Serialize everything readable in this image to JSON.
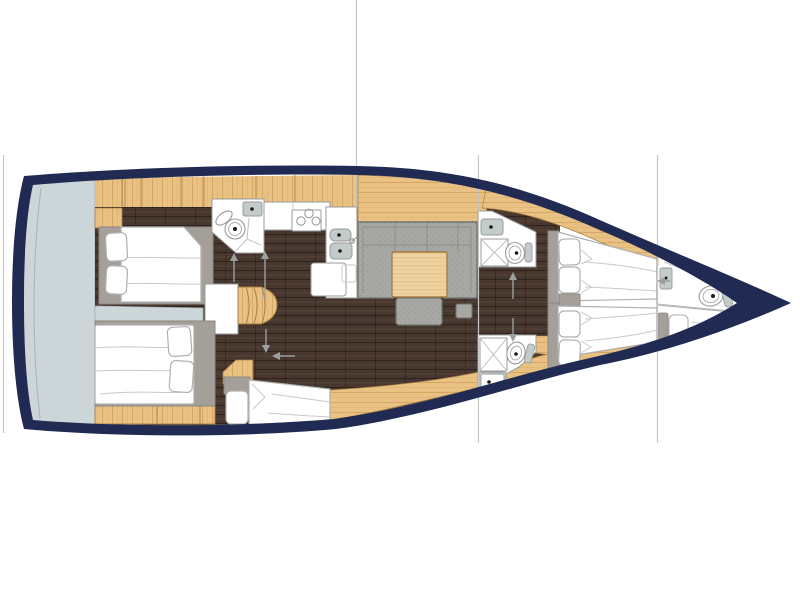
{
  "meta": {
    "type": "sailing-yacht-interior-floor-plan",
    "orientation": "bow-right",
    "canvas": {
      "width": 800,
      "height": 600
    }
  },
  "palette": {
    "background": "#ffffff",
    "hull_navy": "#212a52",
    "deck_gray": "#ccd5d8",
    "deck_gray_line": "#a9b3b7",
    "wood": "#e9c183",
    "wood_grain": "#cfa15c",
    "wood_edge": "#a97f44",
    "wood_light": "#eed2a0",
    "wood_light_grain": "#d9b476",
    "floor_dark": "#47372e",
    "floor_streak_dark": "#2f231d",
    "floor_streak_light": "#5a473c",
    "sofa_gray": "#a7a7a4",
    "sofa_dot": "#929290",
    "sofa_edge": "#73736f",
    "trim_gray": "#a49f98",
    "trim_edge": "#8d8781",
    "fixture_white": "#ffffff",
    "fixture_edge": "#9b9b9b",
    "sink_gray": "#c3cbcb",
    "glass_line": "#b9b9b9",
    "bed_edge": "#b0b0b0",
    "fold_line": "#c9c9c9",
    "section_line": "#c6c6c6",
    "arrow_gray": "#9aa0a0",
    "dot_black": "#1a1a1a"
  },
  "section_lines": {
    "xs": [
      3.5,
      356.5,
      478.5,
      657.5
    ]
  },
  "rooms": [
    {
      "id": "stern-platform",
      "fixtures": []
    },
    {
      "id": "aft-cabin-port",
      "fixtures": [
        "double-bed",
        "pillows",
        "wardrobe-cabinets"
      ]
    },
    {
      "id": "aft-cabin-starboard",
      "fixtures": [
        "double-bed",
        "pillows",
        "drawer-cabinets"
      ]
    },
    {
      "id": "aft-head",
      "fixtures": [
        "toilet",
        "sink",
        "shower-door"
      ]
    },
    {
      "id": "galley",
      "fixtures": [
        "stove-3-burner",
        "double-sink",
        "faucet",
        "counter",
        "island-box"
      ]
    },
    {
      "id": "companionway",
      "fixtures": [
        "stairs"
      ]
    },
    {
      "id": "salon",
      "fixtures": [
        "u-sofa",
        "wood-table",
        "bench-seat",
        "stool",
        "sideboard"
      ]
    },
    {
      "id": "mid-berth-cabin",
      "fixtures": [
        "single-bed",
        "pillow"
      ]
    },
    {
      "id": "fwd-head-port",
      "fixtures": [
        "sink",
        "shower",
        "toilet"
      ]
    },
    {
      "id": "fwd-head-starboard",
      "fixtures": [
        "shower",
        "toilet",
        "sink"
      ]
    },
    {
      "id": "fwd-cabin-port",
      "fixtures": [
        "bed",
        "pillows",
        "nightstand"
      ]
    },
    {
      "id": "fwd-cabin-starboard",
      "fixtures": [
        "bed",
        "pillows",
        "nightstand"
      ]
    },
    {
      "id": "bow-head",
      "fixtures": [
        "toilet",
        "vanity-counter",
        "door-panel",
        "berth-pillow"
      ]
    }
  ],
  "arrows": [
    "aft-head-entry",
    "companionway-down",
    "passage-aft",
    "passage-left",
    "fwd-head-port-entry",
    "fwd-head-starboard-entry",
    "bow-head-entry"
  ]
}
